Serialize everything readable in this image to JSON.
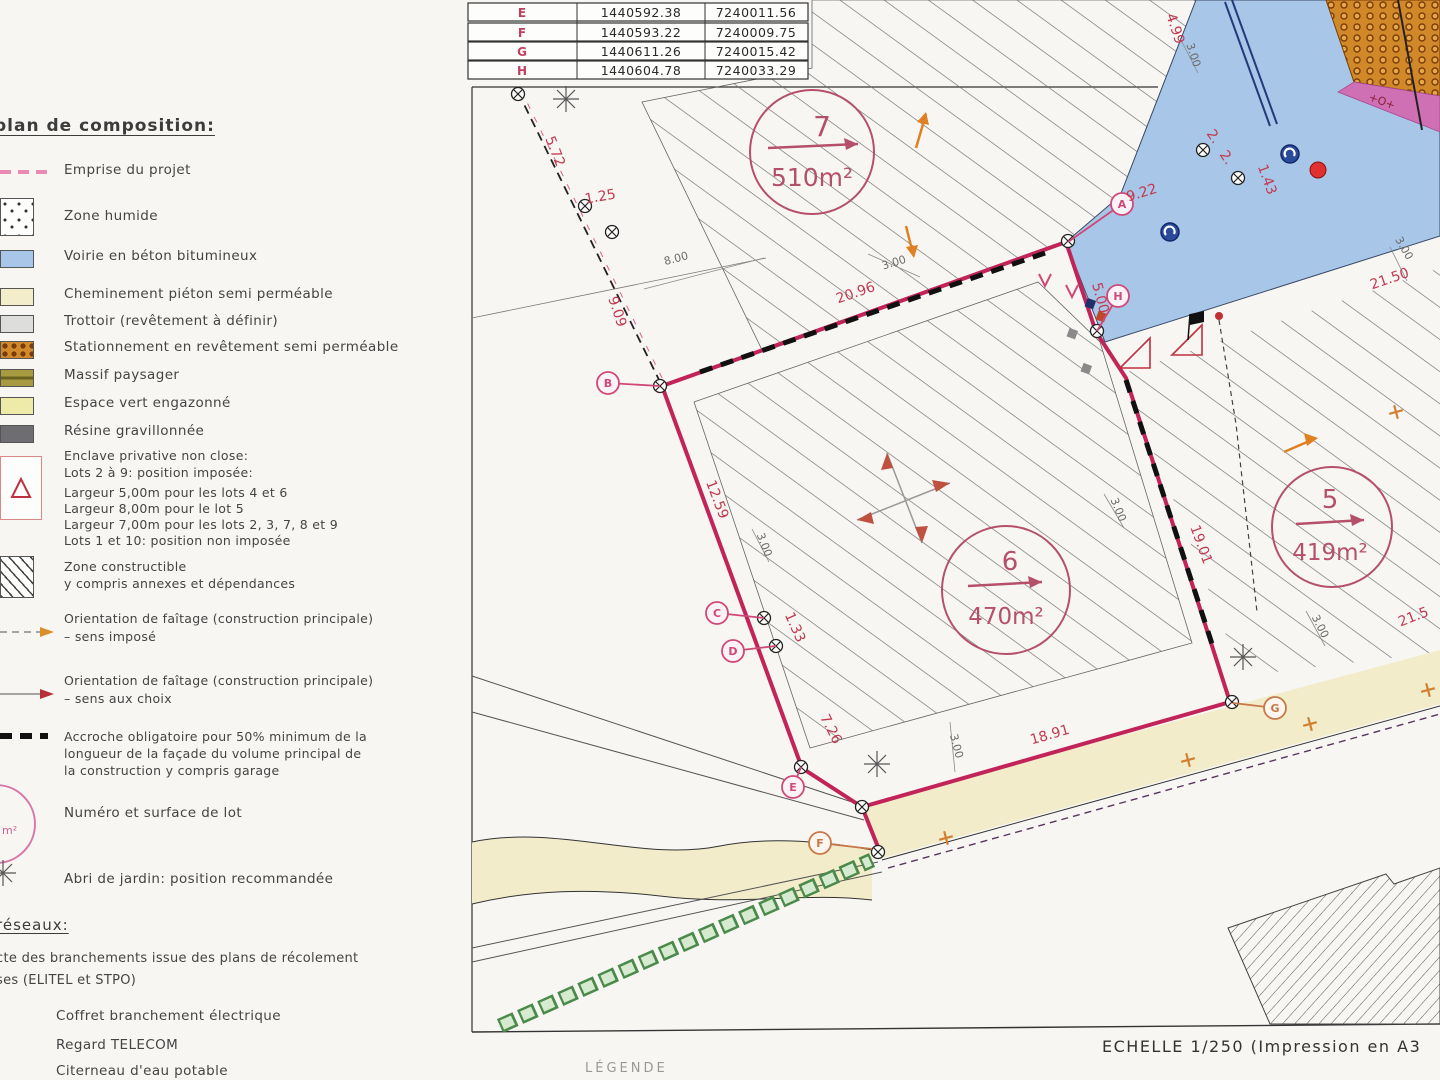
{
  "legend": {
    "title": "plan de composition:",
    "items": [
      "Emprise du projet",
      "Zone humide",
      "Voirie en béton bitumineux",
      "Cheminement piéton semi perméable",
      "Trottoir (revêtement à définir)",
      "Stationnement en revêtement semi perméable",
      "Massif paysager",
      "Espace vert engazonné",
      "Résine gravillonnée"
    ],
    "enclave": [
      "Enclave privative non close:",
      "Lots 2 à 9:  position imposée:",
      "Largeur 5,00m pour les lots 4 et 6",
      "Largeur 8,00m pour le lot 5",
      "Largeur 7,00m pour les lots 2, 3, 7, 8 et 9",
      "Lots 1 et 10:  position non imposée"
    ],
    "constructible": [
      "Zone constructible",
      "y compris annexes et dépendances"
    ],
    "orientation_imposee": [
      "Orientation de faîtage (construction principale)",
      "–     sens imposé"
    ],
    "orientation_choix": [
      "Orientation de faîtage (construction principale)",
      "–     sens aux choix"
    ],
    "accroche": [
      "Accroche obligatoire pour 50% minimum de la",
      "longueur de la façade du volume principal de",
      "la construction y compris garage"
    ],
    "numero": "Numéro et surface de lot",
    "numero_symbol": "m²",
    "abri": "Abri de jardin: position recommandée",
    "reseaux": {
      "title": "réseaux:",
      "note": [
        "cte des branchements issue des plans de récolement",
        "ses (ELITEL et STPO)"
      ],
      "items": [
        "Coffret branchement électrique",
        "Regard TELECOM",
        "Citerneau d'eau potable"
      ]
    }
  },
  "plan": {
    "table": {
      "rows": [
        {
          "pt": "E",
          "x": "1440592.38",
          "y": "7240011.56"
        },
        {
          "pt": "F",
          "x": "1440593.22",
          "y": "7240009.75"
        },
        {
          "pt": "G",
          "x": "1440611.26",
          "y": "7240015.42"
        },
        {
          "pt": "H",
          "x": "1440604.78",
          "y": "7240033.29"
        }
      ]
    },
    "lots": [
      {
        "num": "7",
        "area": "510m²"
      },
      {
        "num": "6",
        "area": "470m²"
      },
      {
        "num": "5",
        "area": "419m²"
      }
    ],
    "point_labels": [
      "A",
      "B",
      "C",
      "D",
      "E",
      "F",
      "G",
      "H"
    ],
    "dims": [
      "5.72",
      "1.25",
      "9.09",
      "8.00",
      "20.96",
      "3.00",
      "9.22",
      "4.99",
      "3.00",
      "2.",
      "2.",
      "1.43",
      "5.00",
      "21.50",
      "3.00",
      "12.59",
      "3.00",
      "1.33",
      "7.26",
      "3.00",
      "18.91",
      "19.01",
      "3.00",
      "3.00",
      "21.5"
    ],
    "parking_mark": "+O+",
    "scale_note": "ECHELLE 1/250 (Impression en A3",
    "partial_caption": "LÉGENDE"
  },
  "colors": {
    "emprise": "#c2245a",
    "road": "#a8c6e8",
    "parking": "#d08828",
    "parking_band": "#cf6fb4",
    "path_cream": "#f2ecca",
    "hedge": "#4a8a4a",
    "dim_red": "#c23a50",
    "dim_grey": "#6a6a6a",
    "lot_label": "#b5506a"
  }
}
